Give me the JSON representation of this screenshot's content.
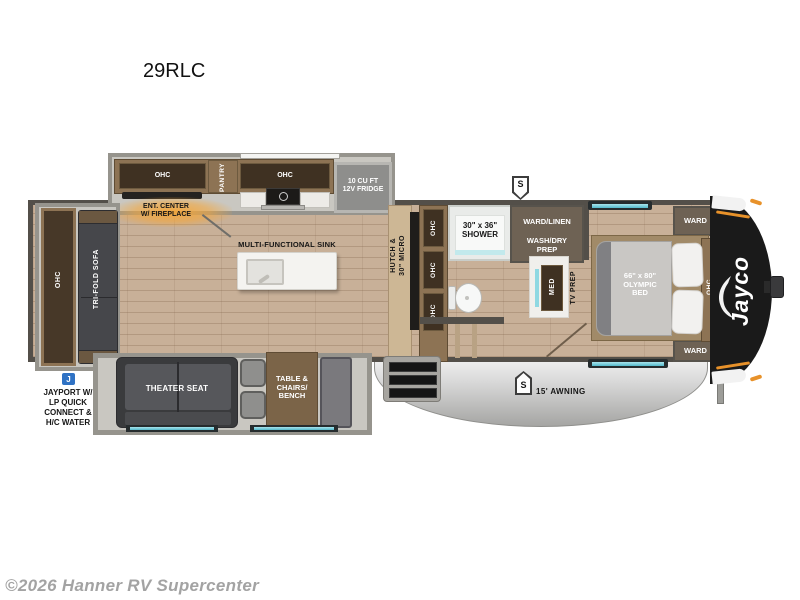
{
  "page": {
    "title": "29RLC",
    "watermark": "©2026 Hanner RV Supercenter"
  },
  "colors": {
    "wall": "#534f49",
    "floor_wood": "#c8b098",
    "cabinet_wood": "#8d7354",
    "cabinet_dark": "#3f3122",
    "window_teal": "#7cd0de",
    "fireplace_glow": "#f5a93f",
    "jayport_blue": "#2f72c4",
    "awning_silver": "#c9c9c9",
    "nose_black": "#1a1a1a",
    "accent_orange": "#e8922a"
  },
  "rear": {
    "ohc": "OHC",
    "sofa": "TRI-FOLD SOFA"
  },
  "jayport": {
    "icon": "J",
    "label": "JAYPORT W/\nLP QUICK\nCONNECT &\nH/C WATER"
  },
  "kitchen": {
    "ohc_left": "OHC",
    "pantry": "PANTRY",
    "ohc_right": "OHC",
    "fridge": "10 CU FT\n12V FRIDGE",
    "ent_center": "ENT. CENTER\nW/ FIREPLACE",
    "sink": "MULTI-FUNCTIONAL SINK",
    "hutch": "HUTCH &\n30\" MICRO",
    "hutch_ohc_top": "OHC",
    "hutch_ohc_mid": "OHC",
    "hutch_ohc_bottom": "OHC"
  },
  "bath": {
    "shower": "30\" x 36\"\nSHOWER",
    "ward_linen": "WARD/LINEN",
    "wash_dry": "WASH/DRY\nPREP",
    "med": "MED",
    "tv_prep": "TV PREP"
  },
  "bedroom": {
    "bed": "66\" x 80\"\nOLYMPIC\nBED",
    "ward_top": "WARD",
    "ward_bottom": "WARD",
    "ohc": "OHC"
  },
  "living": {
    "theater_seat": "THEATER SEAT",
    "table": "TABLE &\nCHAIRS/\nBENCH"
  },
  "exterior": {
    "awning": "15' AWNING",
    "badge_top": "S",
    "badge_awning": "S",
    "brand": "Jayco"
  }
}
